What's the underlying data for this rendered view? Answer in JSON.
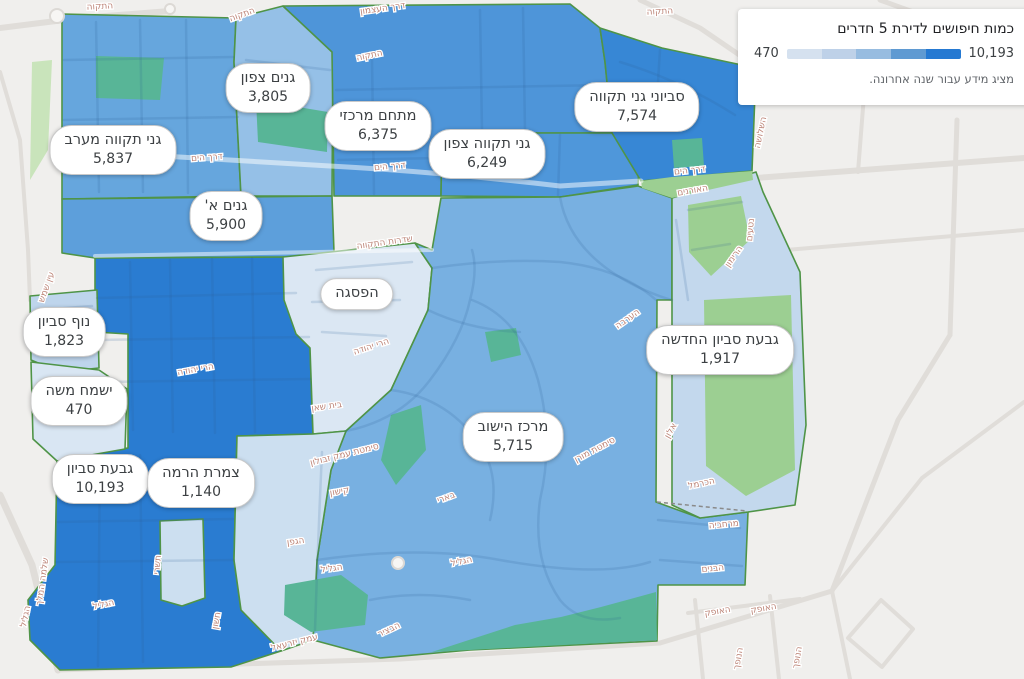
{
  "legend": {
    "title": "כמות חיפושים לדירת 5 חדרים",
    "min_label": "470",
    "max_label": "10,193",
    "note": "מציג מידע עבור שנה אחרונה.",
    "ramp_colors": [
      "#d5e1ef",
      "#bed1e8",
      "#97bce0",
      "#5f9ad2",
      "#2579d2"
    ]
  },
  "map": {
    "background": "#f0efed",
    "region_border_color": "#4f9447",
    "street_line_color": "rgba(45,95,150,0.16)",
    "park_dark_color": "#58b597",
    "park_light_color": "#9ccf92",
    "park_outside_color": "#c9e4bb",
    "road_outside_color": "#e0ddd9",
    "street_label_color": "#bd8578"
  },
  "regions": [
    {
      "id": "gt-west",
      "name": "גני תקווה מערב",
      "value": "5,837",
      "fill": "#66a6dd",
      "label_x": 113,
      "label_y": 150,
      "points": "62,14 236,18 234,62 241,196 62,199"
    },
    {
      "id": "ganim-tzafon",
      "name": "גנים צפון",
      "value": "3,805",
      "fill": "#95c0e7",
      "label_x": 268,
      "label_y": 88,
      "points": "236,18 283,6 333,52 332,196 241,196 234,62"
    },
    {
      "id": "mitcham-merkazi",
      "name": "מתחם מרכזי",
      "value": "6,375",
      "fill": "#4e95d9",
      "label_x": 378,
      "label_y": 126,
      "points": "283,6 570,4 600,28 605,62 612,133 442,133 441,196 334,196 332,52"
    },
    {
      "id": "gt-tzafon",
      "name": "גני תקווה צפון",
      "value": "6,249",
      "fill": "#4f97da",
      "label_x": 487,
      "label_y": 154,
      "points": "442,133 612,133 640,144 638,185 560,197 441,196"
    },
    {
      "id": "savyoney",
      "name": "סביוני גני תקווה",
      "value": "7,574",
      "fill": "#3787d5",
      "label_x": 637,
      "label_y": 107,
      "points": "600,28 662,48 756,68 752,171 641,181 612,133 605,62"
    },
    {
      "id": "ganim-a",
      "name": "גנים א'",
      "value": "5,900",
      "fill": "#5d9fdb",
      "label_x": 226,
      "label_y": 216,
      "points": "62,199 332,196 334,252 296,257 95,258 62,253"
    },
    {
      "id": "givat-savyon",
      "name": "גבעת סביון",
      "value": "10,193",
      "fill": "#2a7cd1",
      "label_x": 100,
      "label_y": 479,
      "points": "95,258 296,257 298,334 310,348 313,434 237,436 234,560 241,610 281,651 231,667 60,670 30,640 28,600 55,565 57,460 95,452 128,448 128,334 95,332"
    },
    {
      "id": "nof-savyon",
      "name": "נוף סביון",
      "value": "1,823",
      "fill": "#bed5ec",
      "label_x": 64,
      "label_y": 332,
      "points": "30,296 97,290 99,368 60,372 31,360"
    },
    {
      "id": "yismach-moshe",
      "name": "ישמח משה",
      "value": "470",
      "fill": "#d9e6f3",
      "label_x": 79,
      "label_y": 401,
      "points": "31,362 99,370 127,389 125,449 57,461 33,439"
    },
    {
      "id": "pisga",
      "name": "הפסגה",
      "value": null,
      "fill": "#dbe7f3",
      "label_x": 357,
      "label_y": 294,
      "points": "283,257 415,243 432,268 428,310 391,390 346,431 313,434 310,348 296,334 284,300"
    },
    {
      "id": "merkaz-hayishuv",
      "name": "מרכז הישוב",
      "value": "5,715",
      "fill": "#78b0e1",
      "label_x": 513,
      "label_y": 437,
      "points": "432,250 441,198 560,197 638,186 672,198 672,300 657,300 656,502 700,518 748,512 745,585 658,585 657,641 470,650 380,658 313,640 317,560 331,470 346,431 391,390 428,310 432,268 415,243"
    },
    {
      "id": "tzameret-harama",
      "name": "צמרת הרמה",
      "value": "1,140",
      "fill": "#ccdff0",
      "label_x": 201,
      "label_y": 483,
      "points": "237,436 313,434 346,431 331,470 317,560 313,640 281,651 241,610 234,560"
    },
    {
      "id": "tzameret-block",
      "name": null,
      "value": null,
      "fill": "#ccdff0",
      "label_x": null,
      "label_y": null,
      "points": "160,521 203,519 205,598 182,606 161,600"
    },
    {
      "id": "givat-hachadasha",
      "name": "גבעת סביון החדשה",
      "value": "1,917",
      "fill": "#c3d8ed",
      "label_x": 720,
      "label_y": 350,
      "points": "672,198 756,172 763,192 800,272 806,425 795,505 748,512 700,518 672,505"
    }
  ],
  "parks": [
    {
      "kind": "outside",
      "points": "32,62 52,60 48,150 30,180"
    },
    {
      "kind": "dark",
      "points": "96,56 164,58 160,100 96,98"
    },
    {
      "kind": "dark",
      "points": "256,100 328,112 327,152 258,142"
    },
    {
      "kind": "dark",
      "points": "672,140 702,138 704,166 674,168"
    },
    {
      "kind": "light",
      "points": "641,181 672,177 752,171 753,180 672,198 642,188"
    },
    {
      "kind": "light",
      "points": "688,205 741,196 750,240 711,276 689,252"
    },
    {
      "kind": "light",
      "points": "704,300 791,295 795,470 746,496 706,466"
    },
    {
      "kind": "dark",
      "points": "485,332 516,328 521,355 491,362"
    },
    {
      "kind": "dark",
      "points": "391,415 421,405 426,450 396,485 381,460"
    },
    {
      "kind": "dark",
      "points": "285,585 341,575 368,595 365,625 311,632 284,615"
    },
    {
      "kind": "dark",
      "points": "515,625 561,617 601,607 656,592 657,640 470,650 432,652"
    }
  ],
  "outside_roads": [
    {
      "d": "M0,28 L80,18 L170,11",
      "w": 6
    },
    {
      "d": "M0,72 L20,140 L28,250 L30,300",
      "w": 4
    },
    {
      "d": "M0,495 L32,565 L58,670",
      "w": 7
    },
    {
      "d": "M58,670 L240,664 L400,659 L660,643 L832,591",
      "w": 5
    },
    {
      "d": "M756,178 L1024,158",
      "w": 6
    },
    {
      "d": "M762,252 L1024,230",
      "w": 4
    },
    {
      "d": "M957,120 L950,335",
      "w": 5
    },
    {
      "d": "M864,95 L858,172",
      "w": 4
    },
    {
      "d": "M950,335 L898,420 L832,591",
      "w": 5
    },
    {
      "d": "M1024,402 L922,478 L832,591",
      "w": 4
    },
    {
      "d": "M832,591 L850,679",
      "w": 4
    },
    {
      "d": "M848,638 L881,600 L913,629 L882,667 Z",
      "w": 4
    },
    {
      "d": "M695,600 L703,679",
      "w": 4
    },
    {
      "d": "M770,596 L779,679",
      "w": 4
    },
    {
      "d": "M688,613 L800,599",
      "w": 4
    },
    {
      "d": "M880,0 L1024,52",
      "w": 5
    },
    {
      "d": "M640,0 L700,28 L757,67",
      "w": 5
    },
    {
      "d": "M757,67 L1024,86",
      "w": 5
    }
  ],
  "inner_streets": [
    {
      "d": "M96,22 L99,192"
    },
    {
      "d": "M140,20 L143,192"
    },
    {
      "d": "M186,20 L188,193"
    },
    {
      "d": "M64,60 L233,57"
    },
    {
      "d": "M64,120 L238,117"
    },
    {
      "d": "M246,60 L330,70"
    },
    {
      "d": "M372,58 L374,194"
    },
    {
      "d": "M480,10 L482,131"
    },
    {
      "d": "M523,8 L525,131"
    },
    {
      "d": "M336,90 L605,85"
    },
    {
      "d": "M338,160 L438,158"
    },
    {
      "d": "M620,62 Q680,80 735,115"
    },
    {
      "d": "M660,50 L655,130"
    },
    {
      "d": "M560,135 L558,195"
    },
    {
      "d": "M97,298 L296,293"
    },
    {
      "d": "M97,340 L309,337"
    },
    {
      "d": "M98,382 L310,379"
    },
    {
      "d": "M130,262 L133,430"
    },
    {
      "d": "M170,260 L173,432"
    },
    {
      "d": "M212,259 L215,433"
    },
    {
      "d": "M252,258 L255,432"
    },
    {
      "d": "M60,480 L232,476"
    },
    {
      "d": "M58,522 L233,519"
    },
    {
      "d": "M56,562 L234,560"
    },
    {
      "d": "M140,455 L143,662"
    },
    {
      "d": "M100,455 L98,666"
    },
    {
      "d": "M346,431 Q400,420 430,380 Q462,338 470,300 Q478,270 472,250"
    },
    {
      "d": "M317,560 Q420,545 500,560 Q600,578 650,562"
    },
    {
      "d": "M472,300 Q520,318 538,380 Q554,440 540,500 Q532,560 560,600 Q580,625 620,618"
    },
    {
      "d": "M391,390 Q450,398 482,448 Q500,478 490,520"
    },
    {
      "d": "M560,197 Q570,255 640,288 Q660,297 672,300"
    },
    {
      "d": "M428,310 Q470,330 520,332"
    },
    {
      "d": "M432,268 Q500,258 560,262 Q620,268 656,300"
    },
    {
      "d": "M370,600 Q420,590 470,600"
    },
    {
      "d": "M658,520 L740,528"
    },
    {
      "d": "M660,560 L742,566"
    },
    {
      "d": "M316,270 L412,262"
    },
    {
      "d": "M312,302 L400,300"
    },
    {
      "d": "M322,332 L386,336"
    },
    {
      "d": "M688,210 L742,202"
    },
    {
      "d": "M692,250 L730,244"
    },
    {
      "d": "M676,220 L688,300"
    },
    {
      "d": "M322,452 Q318,540 315,630"
    },
    {
      "d": "M40,310 L92,306"
    },
    {
      "d": "M40,400 L118,396"
    },
    {
      "d": "M60,418 L115,415"
    }
  ],
  "major_roads_overlay": [
    {
      "d": "M62,150 Q200,158 330,166 Q440,172 560,186 L641,181",
      "w": 5
    },
    {
      "d": "M95,256 L432,250",
      "w": 4
    }
  ],
  "dashed_boundaries": [
    {
      "d": "M657,502 L747,511"
    }
  ],
  "roundabouts": [
    {
      "cx": 57,
      "cy": 16,
      "r": 7
    },
    {
      "cx": 170,
      "cy": 9,
      "r": 5
    },
    {
      "cx": 398,
      "cy": 563,
      "r": 6
    }
  ],
  "street_labels": [
    {
      "t": "התקוה",
      "x": 100,
      "y": 9,
      "r": -3
    },
    {
      "t": "התקוה",
      "x": 243,
      "y": 17,
      "r": -20
    },
    {
      "t": "דרך העצמון",
      "x": 383,
      "y": 11,
      "r": -8
    },
    {
      "t": "התקוה",
      "x": 370,
      "y": 58,
      "r": -12
    },
    {
      "t": "התקוה",
      "x": 660,
      "y": 14,
      "r": -3
    },
    {
      "t": "דרך הים",
      "x": 207,
      "y": 160,
      "r": -4
    },
    {
      "t": "דרך הים",
      "x": 390,
      "y": 169,
      "r": -5
    },
    {
      "t": "דרך הים",
      "x": 690,
      "y": 173,
      "r": -6
    },
    {
      "t": "האורנים",
      "x": 693,
      "y": 193,
      "r": -10
    },
    {
      "t": "שדרות התקווה",
      "x": 385,
      "y": 245,
      "r": -8
    },
    {
      "t": "עין שמש",
      "x": 49,
      "y": 288,
      "r": -70
    },
    {
      "t": "הרי יהודה",
      "x": 196,
      "y": 372,
      "r": -10
    },
    {
      "t": "הרי יהודה",
      "x": 372,
      "y": 349,
      "r": -18
    },
    {
      "t": "בית שאן",
      "x": 327,
      "y": 409,
      "r": -8
    },
    {
      "t": "הערבה",
      "x": 629,
      "y": 321,
      "r": -35
    },
    {
      "t": "סימטת עמק זבולון",
      "x": 345,
      "y": 457,
      "r": -14
    },
    {
      "t": "קישון",
      "x": 340,
      "y": 494,
      "r": -10
    },
    {
      "t": "בארי",
      "x": 447,
      "y": 500,
      "r": -20
    },
    {
      "t": "סימטת מורן",
      "x": 596,
      "y": 452,
      "r": -28
    },
    {
      "t": "הגפן",
      "x": 296,
      "y": 544,
      "r": -8
    },
    {
      "t": "הגליל",
      "x": 332,
      "y": 571,
      "r": -8
    },
    {
      "t": "הגליל",
      "x": 104,
      "y": 607,
      "r": -12
    },
    {
      "t": "הגליל",
      "x": 462,
      "y": 564,
      "r": -12
    },
    {
      "t": "הגליל",
      "x": 28,
      "y": 617,
      "r": -78
    },
    {
      "t": "עמק יזרעאל",
      "x": 295,
      "y": 645,
      "r": -14
    },
    {
      "t": "הבציר",
      "x": 390,
      "y": 632,
      "r": -25
    },
    {
      "t": "תשרי",
      "x": 160,
      "y": 565,
      "r": -85
    },
    {
      "t": "חשון",
      "x": 219,
      "y": 621,
      "r": -80
    },
    {
      "t": "שלמה המלך",
      "x": 45,
      "y": 582,
      "r": -82
    },
    {
      "t": "אלון",
      "x": 673,
      "y": 432,
      "r": -60
    },
    {
      "t": "הכרמל",
      "x": 702,
      "y": 486,
      "r": -12
    },
    {
      "t": "מרחביה",
      "x": 724,
      "y": 527,
      "r": -5
    },
    {
      "t": "הבנים",
      "x": 713,
      "y": 571,
      "r": -5
    },
    {
      "t": "האופק",
      "x": 718,
      "y": 614,
      "r": -10
    },
    {
      "t": "האופק",
      "x": 764,
      "y": 611,
      "r": -10
    },
    {
      "t": "הנופך",
      "x": 741,
      "y": 659,
      "r": -80
    },
    {
      "t": "הנופך",
      "x": 800,
      "y": 658,
      "r": -80
    },
    {
      "t": "השלושה",
      "x": 763,
      "y": 133,
      "r": -78
    },
    {
      "t": "נטעים",
      "x": 753,
      "y": 230,
      "r": -85
    },
    {
      "t": "הרימון",
      "x": 736,
      "y": 258,
      "r": -55
    }
  ]
}
